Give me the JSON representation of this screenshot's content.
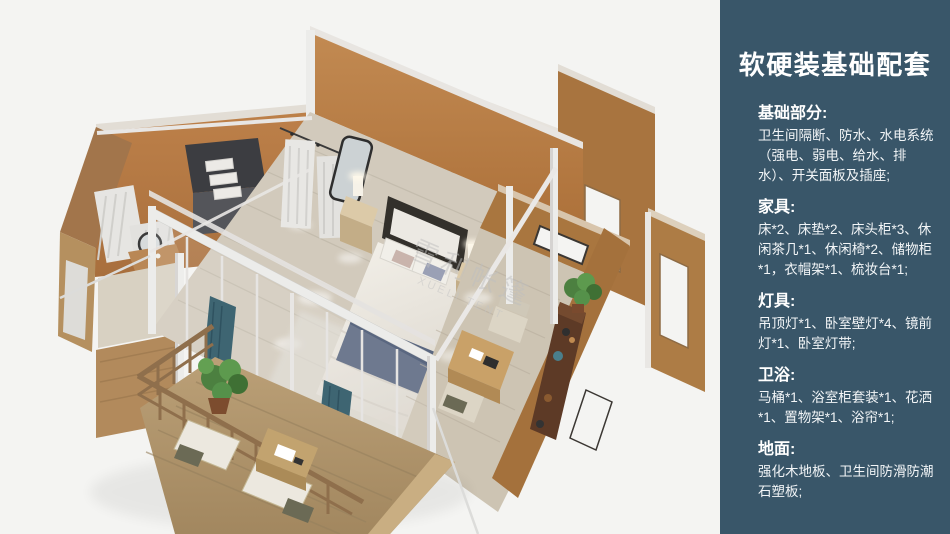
{
  "palette": {
    "sidebar_bg": "#395669",
    "wall_orange": "#b97c46",
    "wall_tan": "#aa7743",
    "floor_wood": "#d2cabc",
    "deck_wood": "#b49a74",
    "frame_white": "#ececea",
    "accent_teal": "#3e6572",
    "bed_blue": "#5a6780",
    "plant_green": "#4c8040",
    "watermark_gray": "#bfbfbf"
  },
  "floorplan": {
    "watermark_line1": "雪利帐篷",
    "watermark_line2": "XUELI TENT"
  },
  "sidebar": {
    "title": "软硬装基础配套",
    "sections": [
      {
        "heading": "基础部分:",
        "body": "卫生间隔断、防水、水电系统（强电、弱电、给水、排水）、开关面板及插座;"
      },
      {
        "heading": "家具:",
        "body": "床*2、床垫*2、床头柜*3、休闲茶几*1、休闲椅*2、储物柜*1，衣帽架*1、梳妆台*1;"
      },
      {
        "heading": "灯具:",
        "body": "吊顶灯*1、卧室壁灯*4、镜前灯*1、卧室灯带;"
      },
      {
        "heading": "卫浴:",
        "body": "马桶*1、浴室柜套装*1、花洒*1、置物架*1、浴帘*1;"
      },
      {
        "heading": "地面:",
        "body": "强化木地板、卫生间防滑防潮石塑板;"
      }
    ]
  }
}
